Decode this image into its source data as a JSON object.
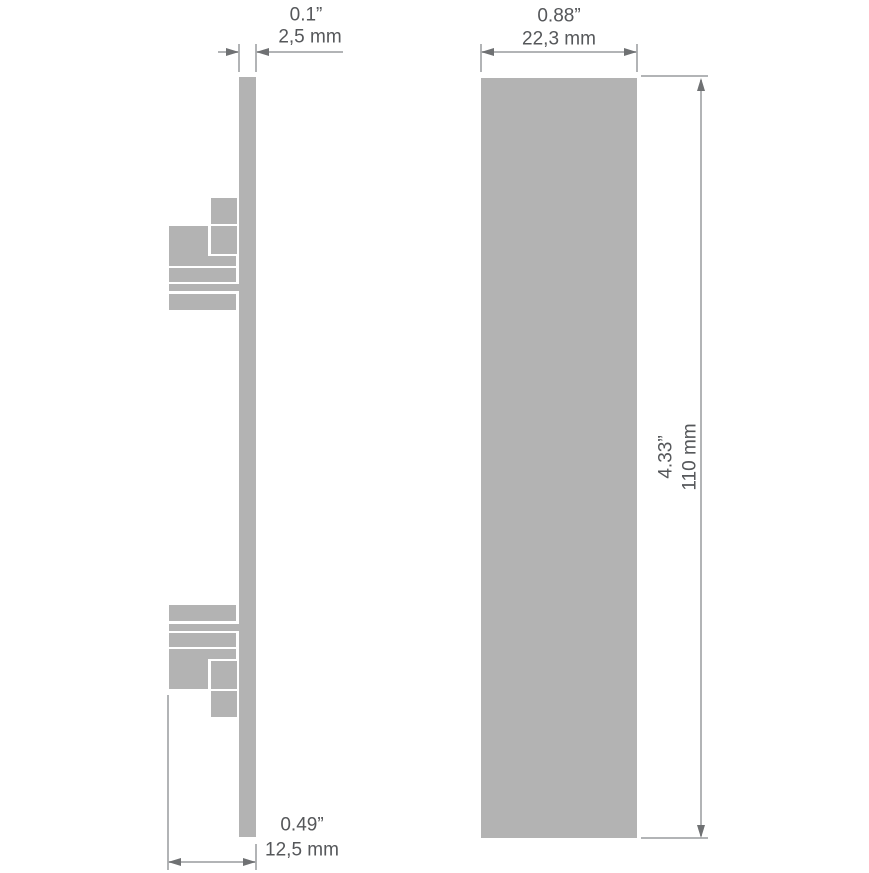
{
  "colors": {
    "background": "#ffffff",
    "shape_fill": "#b3b3b3",
    "dimension_line": "#b2b4b6",
    "arrowhead": "#6f7173",
    "text": "#55575a"
  },
  "dimensions": {
    "thickness": {
      "inch": "0.1”",
      "mm": "2,5 mm"
    },
    "width": {
      "inch": "0.88”",
      "mm": "22,3 mm"
    },
    "height": {
      "inch": "4.33”",
      "mm": "110 mm"
    },
    "depth": {
      "inch": "0.49”",
      "mm": "12,5 mm"
    }
  }
}
